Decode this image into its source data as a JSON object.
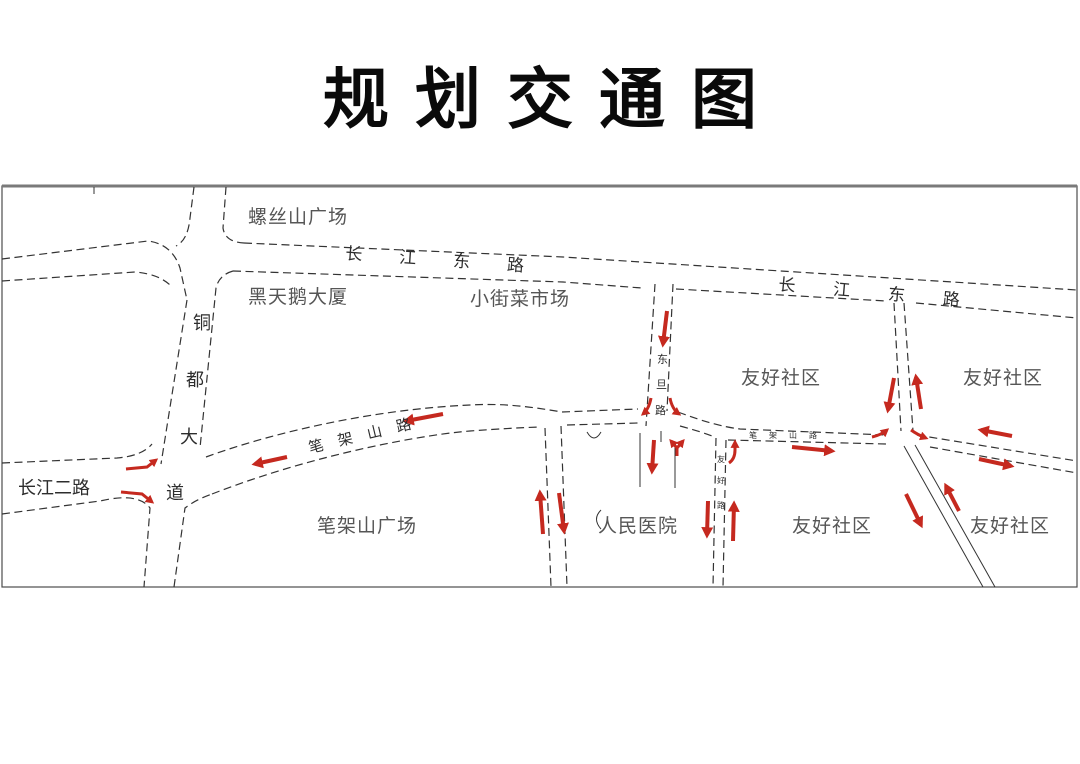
{
  "title": "规划交通图",
  "colors": {
    "arrow": "#c5291f",
    "road_line": "#333333",
    "place_label": "#565656",
    "road_label": "#2d2d2d",
    "border": "#4c4c4c",
    "background": "#ffffff"
  },
  "map": {
    "places": {
      "luosishan_square": "螺丝山广场",
      "black_swan_tower": "黑天鹅大厦",
      "xiaojie_market": "小街菜市场",
      "friendly_community": "友好社区",
      "peoples_hospital": "人民医院",
      "bijiashan_square": "笔架山广场"
    },
    "roads": {
      "changjiang_east_road": "长江东路",
      "changjiang_second_road": "长江二路",
      "tongdu_avenue": [
        "铜",
        "都",
        "大",
        "道"
      ],
      "bijiashan_road": "笔架山路",
      "dongdan_road": [
        "东",
        "旦",
        "路"
      ],
      "youhao_road": [
        "友",
        "好",
        "路"
      ]
    }
  }
}
